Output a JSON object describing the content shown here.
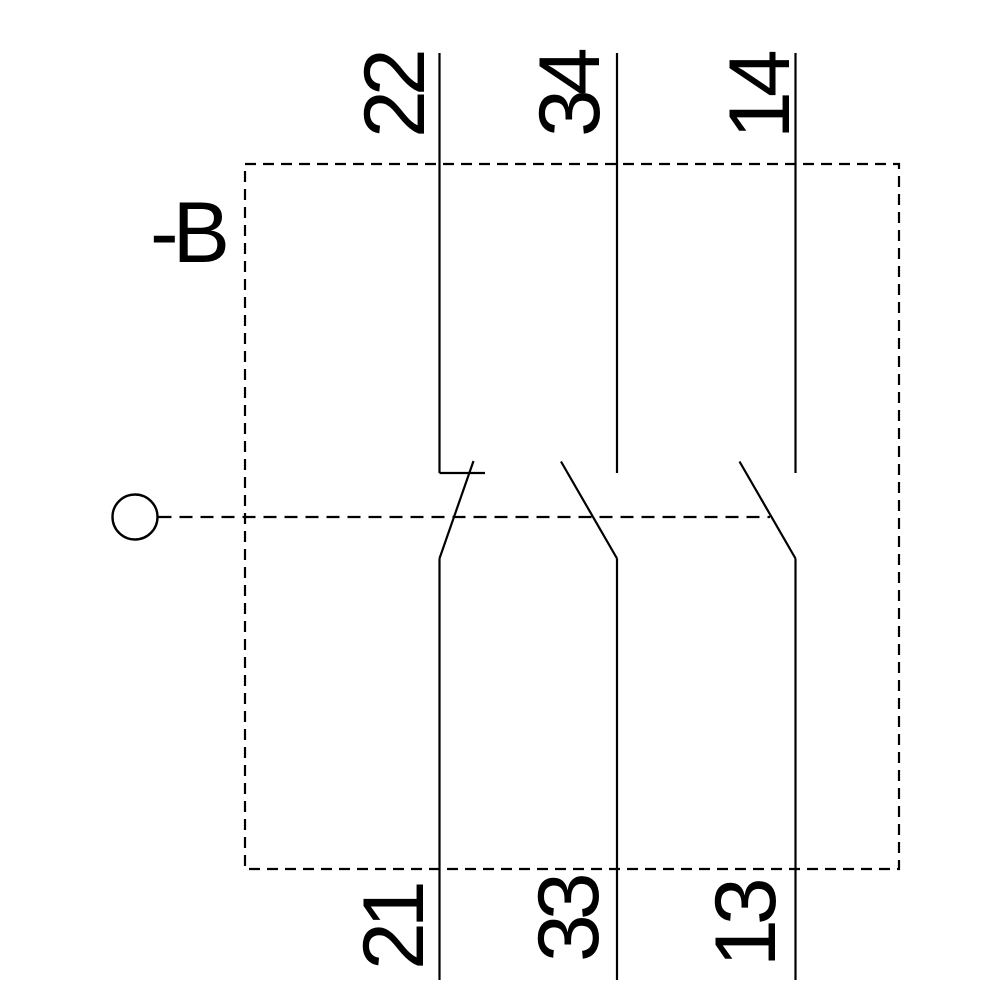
{
  "diagram": {
    "kind": "contact-block-circuit-schematic",
    "device_label": "-B",
    "line_color": "#000000",
    "background_color": "#ffffff",
    "boundary_style": "dashed",
    "linkage_style": "dashed",
    "actuator_icon": "operator-circle",
    "contacts": [
      {
        "top_terminal": "22",
        "bottom_terminal": "21",
        "symbol": "nc-contact"
      },
      {
        "top_terminal": "34",
        "bottom_terminal": "33",
        "symbol": "no-contact"
      },
      {
        "top_terminal": "14",
        "bottom_terminal": "13",
        "symbol": "no-contact"
      }
    ]
  }
}
